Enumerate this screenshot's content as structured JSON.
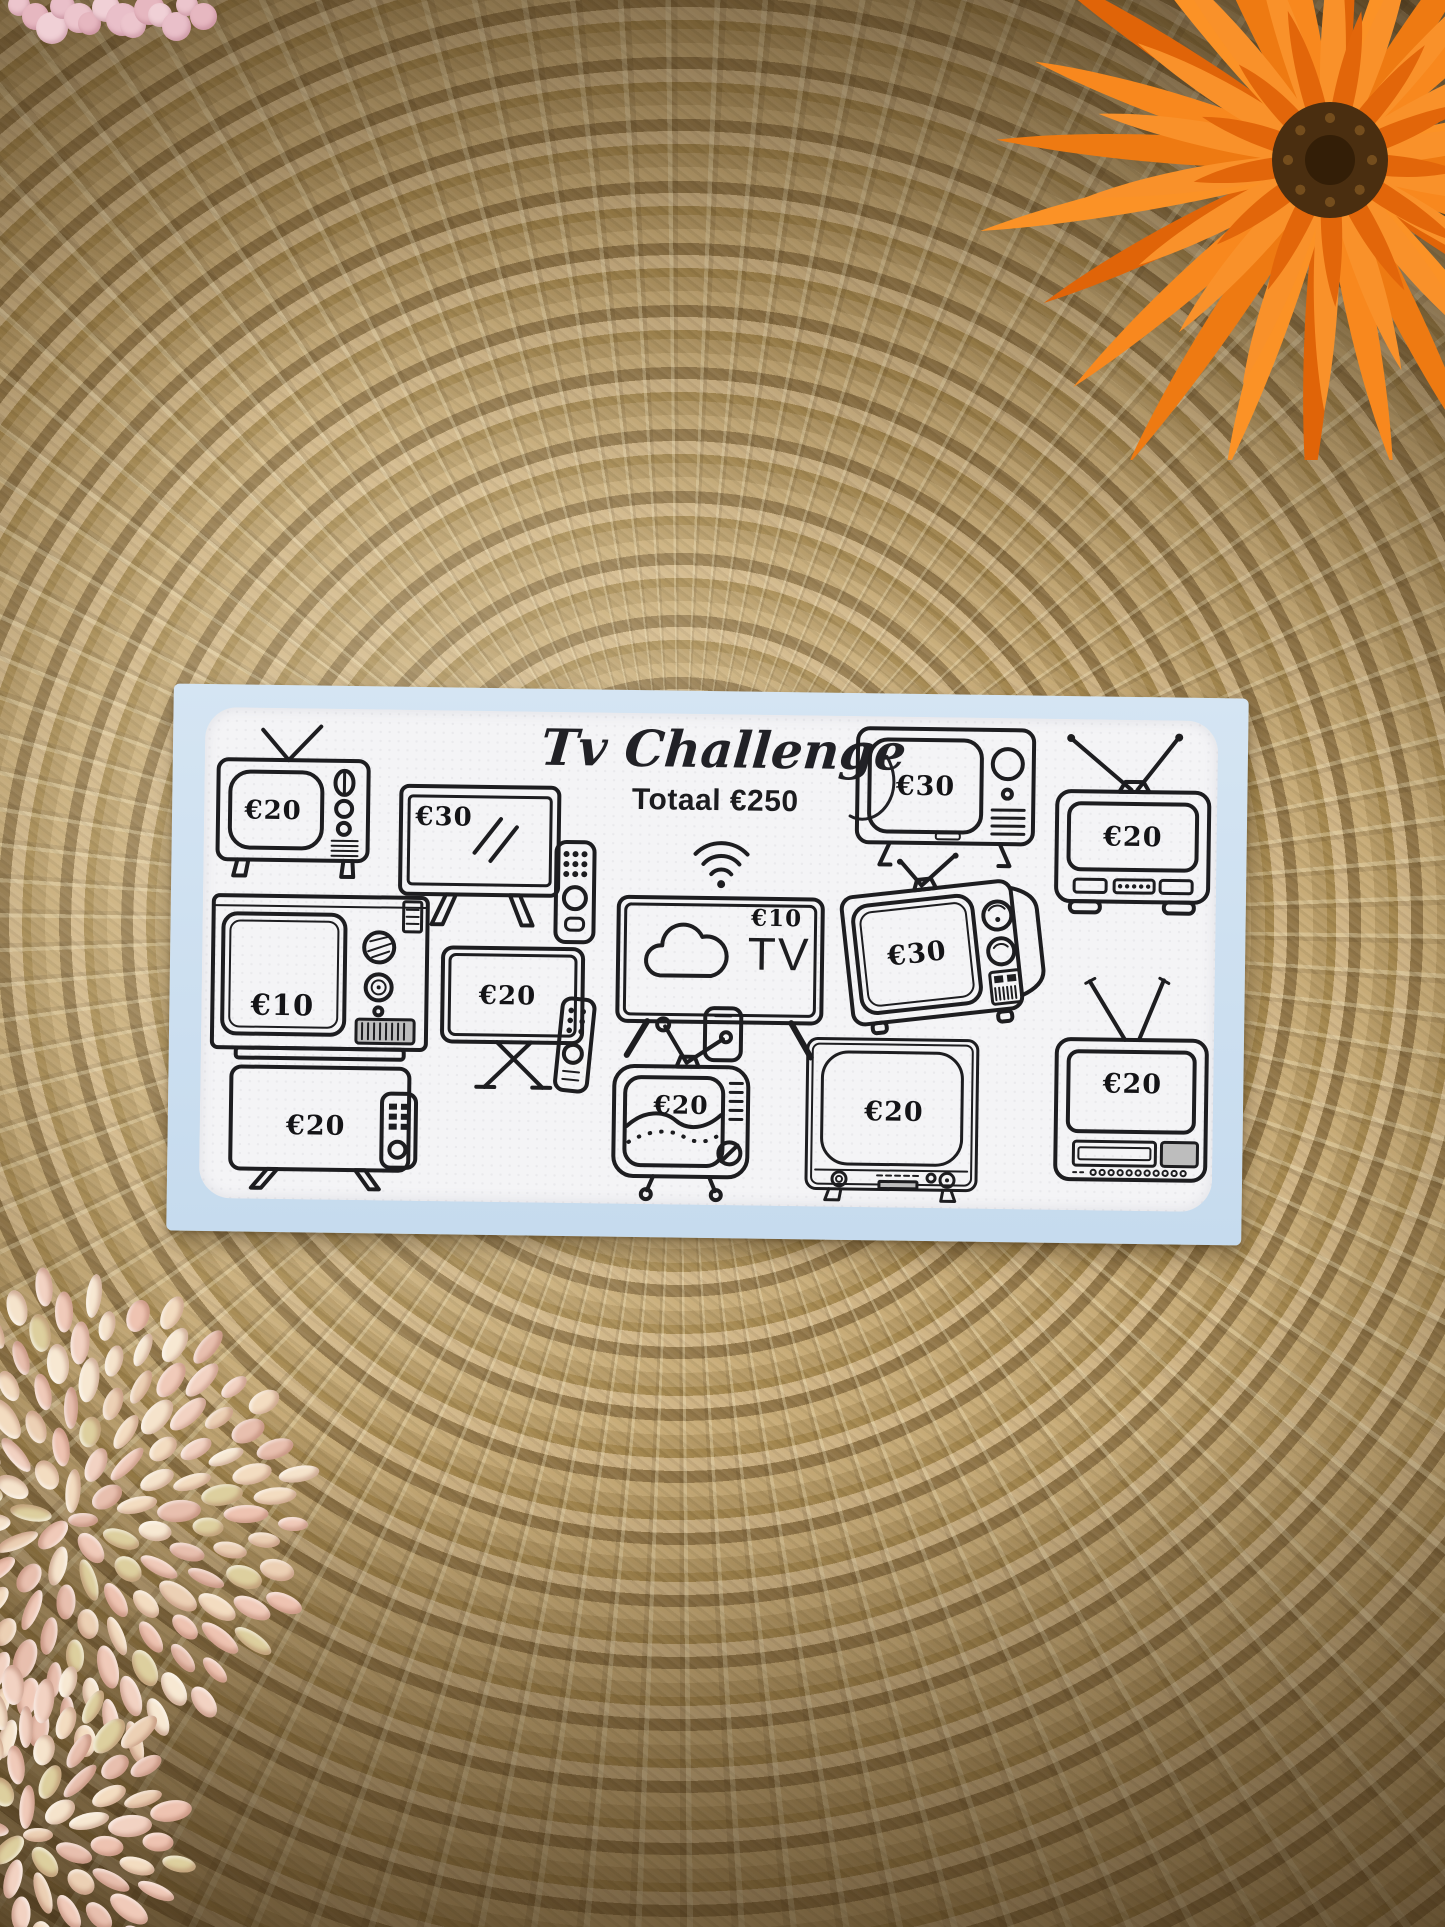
{
  "card": {
    "title": "Tv Challenge",
    "subtitle": "Totaal €250",
    "tvs": [
      {
        "name": "retro-tv-knobs",
        "amount": "€20"
      },
      {
        "name": "flatscreen-tv-remote",
        "amount": "€30"
      },
      {
        "name": "retro-tv-round-knob",
        "amount": "€30"
      },
      {
        "name": "portable-tv-v-antenna",
        "amount": "€20"
      },
      {
        "name": "vintage-cabinet-tv",
        "amount": "€10"
      },
      {
        "name": "smart-tv-cloud",
        "amount": "€10",
        "screen_text": "TV"
      },
      {
        "name": "retro-tv-rabbit-ears",
        "amount": "€30"
      },
      {
        "name": "monitor-with-remote",
        "amount": "€20"
      },
      {
        "name": "flat-tv-with-remote",
        "amount": "€20"
      },
      {
        "name": "mini-retro-tv-wave",
        "amount": "€20"
      },
      {
        "name": "classic-crt-tv",
        "amount": "€20"
      },
      {
        "name": "tv-vcr-combo",
        "amount": "€20"
      }
    ]
  },
  "colors": {
    "card_blue": "#cddff0",
    "panel_white": "#f4f4f6",
    "ink": "#1d1d20",
    "flower_orange": "#ef7d12",
    "flower_center_brown": "#4a2e10",
    "pompon_pink": "#f0cfc0",
    "placemat_tan": "#b69a66",
    "yarn_pink": "#ecc5cd"
  }
}
